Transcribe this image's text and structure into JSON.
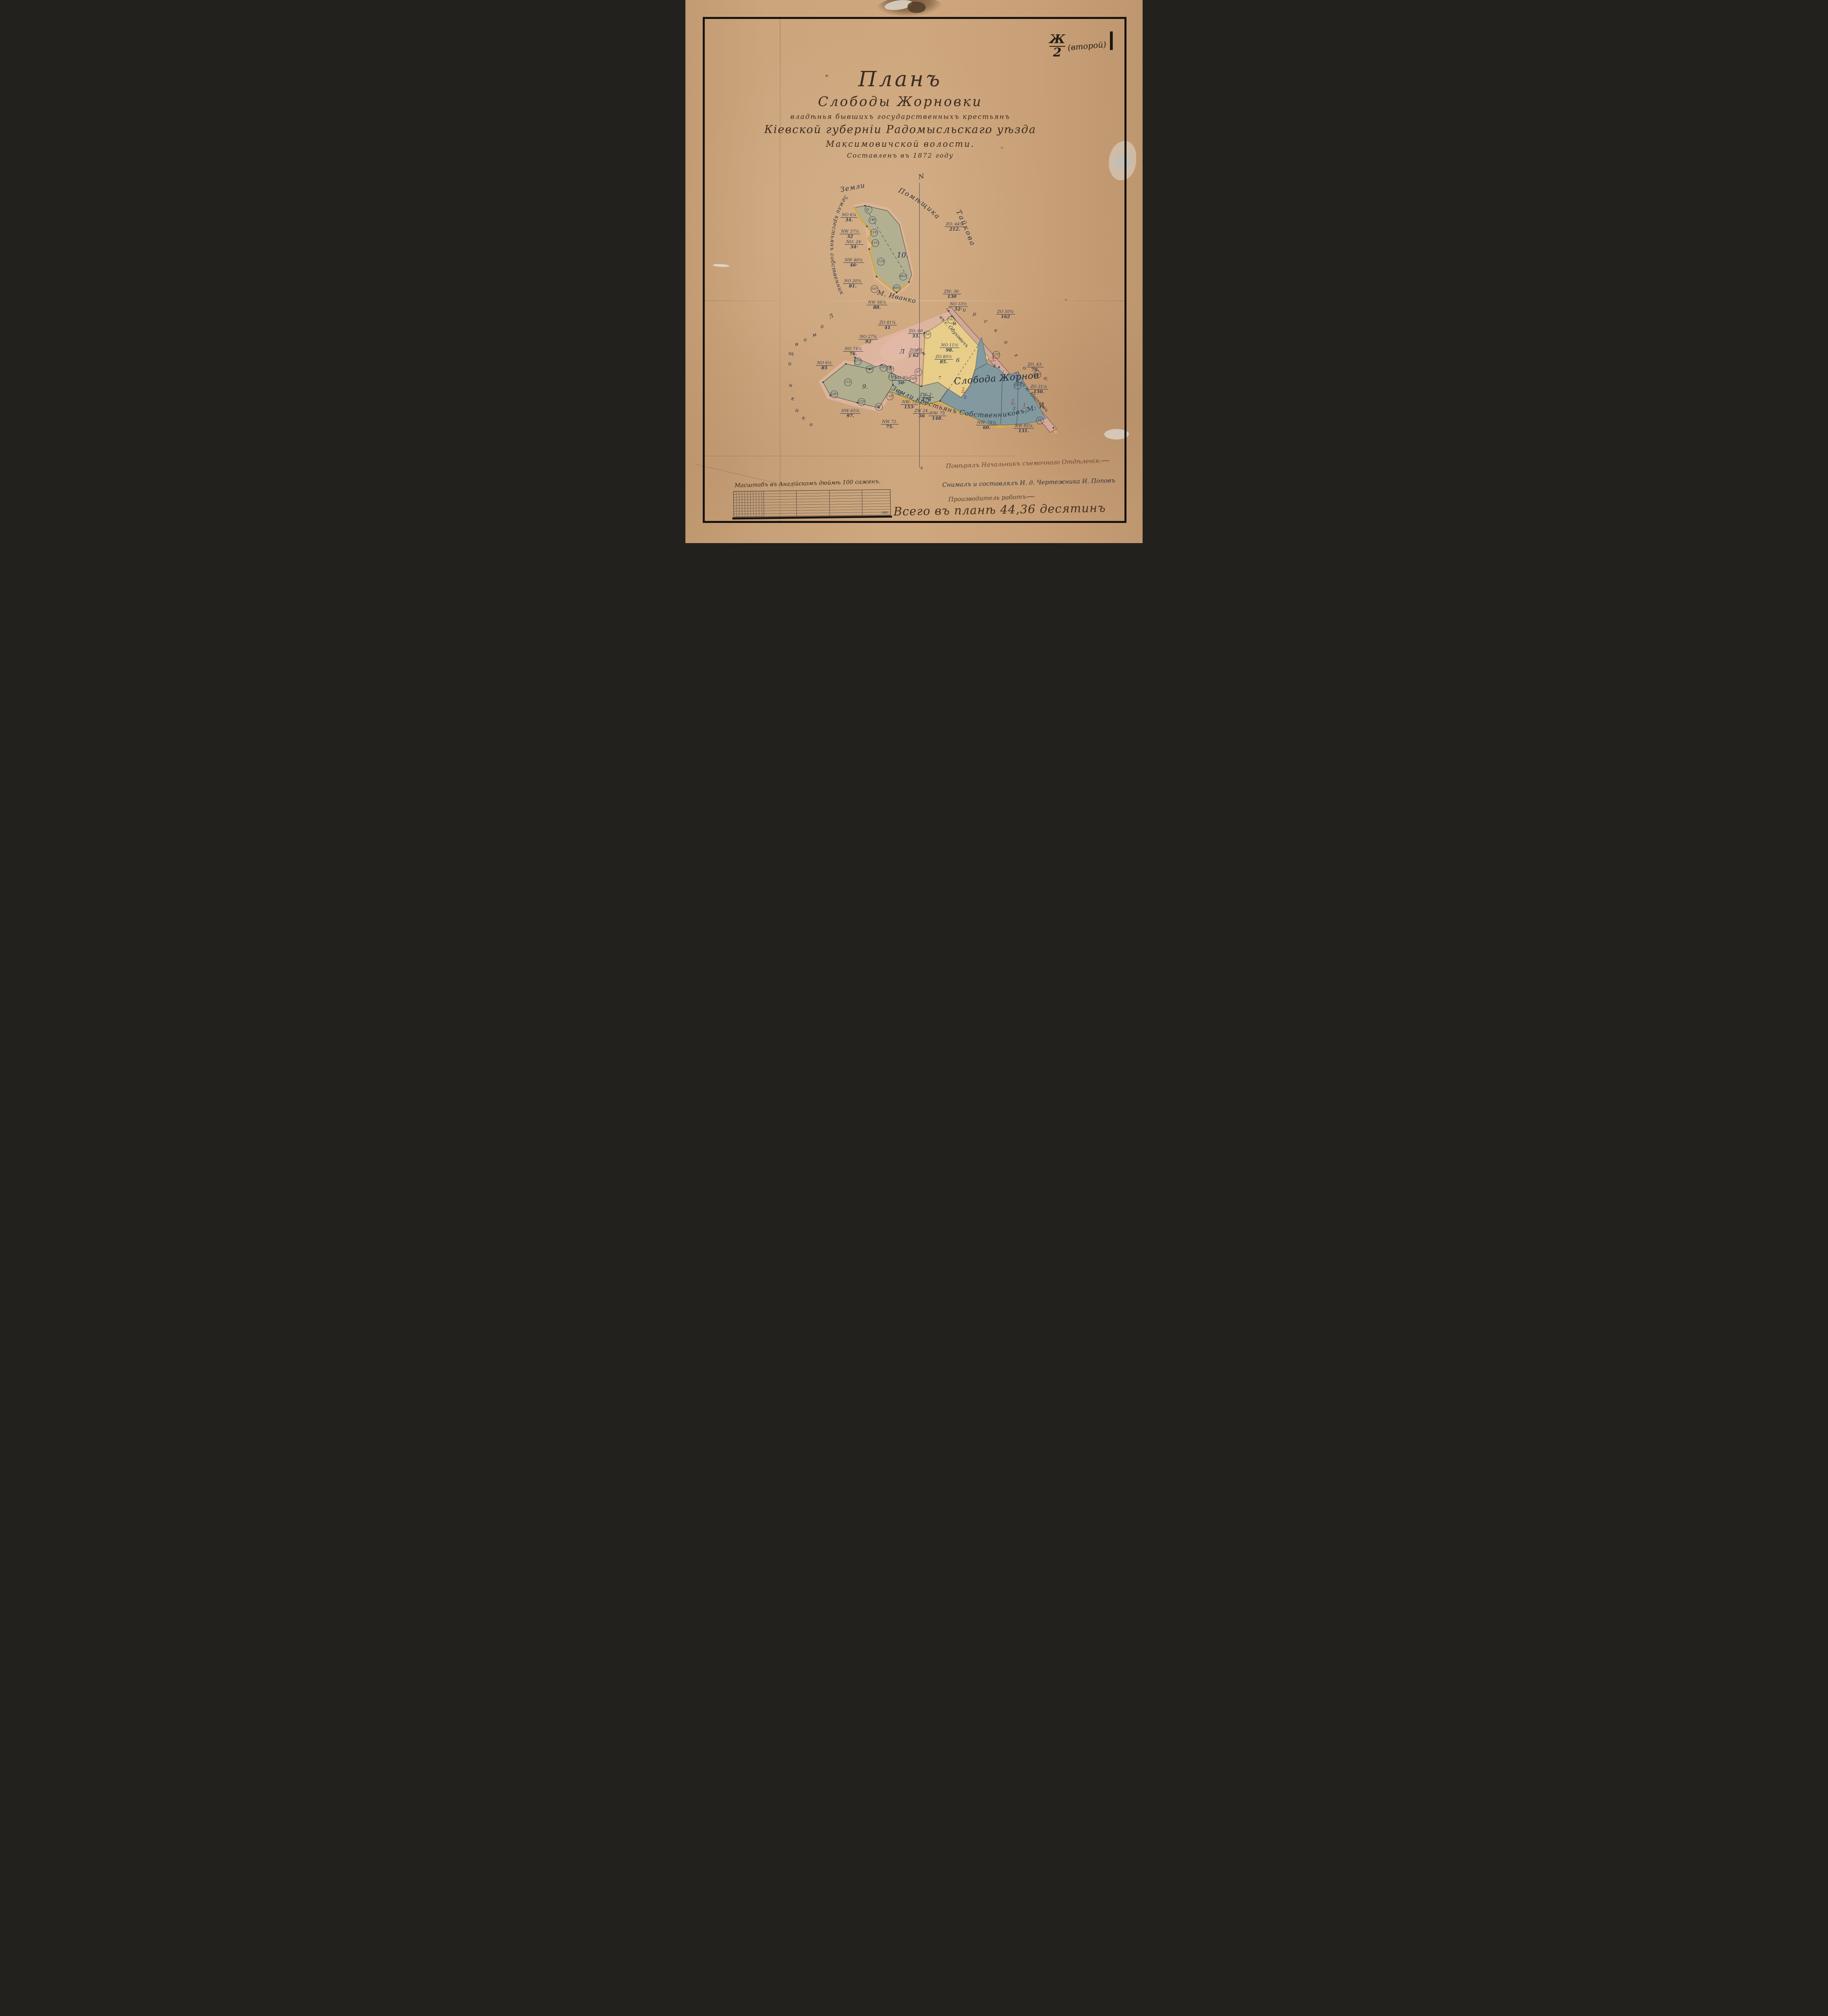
{
  "stamp": {
    "numerator": "Ж",
    "denominator": "2",
    "suffix": "(второй)"
  },
  "title": {
    "l1": "Планъ",
    "l2": "Слободы Жорновки",
    "l3": "владѣнья бывшихъ государственныхъ крестьянъ",
    "l4": "Кіевской губерніи Радомысльскаго уѣзда",
    "l5": "Максимовичской волости.",
    "l6": "Составленъ въ 1872 году"
  },
  "compass": {
    "north": "N",
    "south": "s"
  },
  "labels": {
    "top1": "Земли",
    "top2": "Помѣщика",
    "top3": "Тайкова",
    "left_arc": "Земли крестьянъ собственниковъ",
    "left_owner": "М. Иванкова",
    "bottom_boundary": "Земли крестьянъ Собственниковъ М: Иванкова.",
    "settlement": "Слобода Жорновка.",
    "road_upper": "въ с. Обуховичъ",
    "road_lower": "въ м. Иванковъ"
  },
  "colors": {
    "paper": "#cda67e",
    "ink": "#313a4e",
    "red": "#9c2c40",
    "green_parcel": "#b4b193",
    "yellow_parcel": "#e9cf8a",
    "blue_parcel": "#7f9aa3",
    "pink_edge": "#e7bcae",
    "road": "#d2a99b",
    "gold_edge": "#dcae4a"
  },
  "parcel_numbers": [
    {
      "n": "10.",
      "x": 47.5,
      "y": 47.0,
      "s": 18
    },
    {
      "n": "9.",
      "x": 39.3,
      "y": 71.2,
      "s": 15
    },
    {
      "n": "8",
      "x": 46.8,
      "y": 72.4,
      "s": 15
    },
    {
      "n": "6",
      "x": 59.6,
      "y": 66.4,
      "s": 14
    },
    {
      "n": "7",
      "x": 55.6,
      "y": 69.6,
      "s": 10
    },
    {
      "n": "4",
      "x": 67.6,
      "y": 67.4,
      "s": 11
    },
    {
      "n": "5",
      "x": 61.2,
      "y": 73.2,
      "s": 11
    },
    {
      "n": "3",
      "x": 72.6,
      "y": 70.4,
      "s": 11
    },
    {
      "n": "2",
      "x": 71.9,
      "y": 75.2,
      "s": 11
    },
    {
      "n": "1",
      "x": 74.5,
      "y": 75.9,
      "s": 10
    }
  ],
  "red_numbers": [
    {
      "n": "4",
      "x": 67.3,
      "y": 65.9
    },
    {
      "n": "2",
      "x": 60.8,
      "y": 71.7
    },
    {
      "n": "3",
      "x": 72.2,
      "y": 69.0
    },
    {
      "n": "2",
      "x": 71.6,
      "y": 73.9
    },
    {
      "n": "1",
      "x": 74.2,
      "y": 74.6
    }
  ],
  "bearings": [
    {
      "dir": "NO",
      "deg": "6¼",
      "dist": "34.",
      "x": 35.8,
      "y": 40.1
    },
    {
      "dir": "NW",
      "deg": "37¼",
      "dist": "32",
      "x": 36.0,
      "y": 43.1
    },
    {
      "dir": "NO:",
      "deg": "24·",
      "dist": "34·",
      "x": 36.9,
      "y": 45.1
    },
    {
      "dir": "NW",
      "deg": "40¼",
      "dist": "46·",
      "x": 36.8,
      "y": 48.4
    },
    {
      "dir": "NO",
      "deg": "20¼",
      "dist": "81.",
      "x": 36.6,
      "y": 52.3
    },
    {
      "dir": "NW",
      "deg": "56⅞",
      "dist": "88.",
      "x": 41.9,
      "y": 56.2
    },
    {
      "dir": "ZO:",
      "deg": "44¼",
      "dist": "212.",
      "x": 58.9,
      "y": 41.8
    },
    {
      "dir": "ZW:",
      "deg": "36·",
      "dist": "130",
      "x": 58.3,
      "y": 54.2
    },
    {
      "dir": "ZO",
      "deg": "81¾",
      "dist": "41",
      "x": 44.2,
      "y": 59.9
    },
    {
      "dir": "ZO:",
      "deg": "60",
      "dist": "33.",
      "x": 50.4,
      "y": 61.5
    },
    {
      "dir": "NO",
      "deg": "27¾",
      "dist": "92",
      "x": 40.0,
      "y": 62.5
    },
    {
      "dir": "NO",
      "deg": "74½",
      "dist": "76.",
      "x": 36.7,
      "y": 64.7
    },
    {
      "dir": "NO",
      "deg": "6½",
      "dist": "85",
      "x": 30.4,
      "y": 67.3
    },
    {
      "dir": "NW",
      "deg": "65¼",
      "dist": "97.",
      "x": 36.1,
      "y": 76.2
    },
    {
      "dir": "NW",
      "deg": "72.",
      "dist": "75.",
      "x": 44.7,
      "y": 78.2
    },
    {
      "dir": "ZW",
      "deg": "24.",
      "dist": "56",
      "x": 51.7,
      "y": 76.2
    },
    {
      "dir": "ZW:",
      "deg": "2·",
      "dist": "176",
      "x": 52.7,
      "y": 73.2
    },
    {
      "dir": "NO",
      "deg": "33½",
      "dist": "52·",
      "x": 59.7,
      "y": 56.5
    },
    {
      "dir": "ZO",
      "deg": "50¾",
      "dist": "162",
      "x": 70.0,
      "y": 57.9
    },
    {
      "dir": "NO",
      "deg": "11½",
      "dist": "98.",
      "x": 57.8,
      "y": 64.1
    },
    {
      "dir": "ZO",
      "deg": "85½",
      "dist": "85.",
      "x": 56.5,
      "y": 66.2
    },
    {
      "dir": "ZO",
      "deg": "75",
      "dist": "62",
      "x": 50.4,
      "y": 65.0
    },
    {
      "dir": "NO",
      "deg": "9¼",
      "dist": "50·",
      "x": 47.3,
      "y": 70.1
    },
    {
      "dir": "ZO,",
      "deg": "43·",
      "dist": "70.",
      "x": 76.5,
      "y": 67.6
    },
    {
      "dir": "NW:",
      "deg": "73",
      "dist": "153·",
      "x": 49.0,
      "y": 74.5
    },
    {
      "dir": "NW:",
      "deg": "75",
      "dist": "148.",
      "x": 55.1,
      "y": 76.6
    },
    {
      "dir": "NW:",
      "deg": "74¼",
      "dist": "60.",
      "x": 65.9,
      "y": 78.3
    },
    {
      "dir": "NW",
      "deg": "85¼",
      "dist": "131.",
      "x": 74.0,
      "y": 78.9
    },
    {
      "dir": "ZO",
      "deg": "31¼",
      "dist": "150.",
      "x": 77.3,
      "y": 71.7
    }
  ],
  "angles": [
    {
      "v": "51·",
      "x": 40.0,
      "y": 38.6
    },
    {
      "v": "136",
      "x": 40.9,
      "y": 40.5
    },
    {
      "v": "118¾",
      "x": 41.3,
      "y": 42.8
    },
    {
      "v": "115¾",
      "x": 41.5,
      "y": 44.8
    },
    {
      "v": "119",
      "x": 42.8,
      "y": 48.2
    },
    {
      "v": "99½",
      "x": 47.6,
      "y": 50.9
    },
    {
      "v": "105¾",
      "x": 41.4,
      "y": 53.2
    },
    {
      "v": "89¾",
      "x": 46.2,
      "y": 53.1
    },
    {
      "v": "105·",
      "x": 43.3,
      "y": 67.7
    },
    {
      "v": "156¾",
      "x": 44.8,
      "y": 68.0
    },
    {
      "v": "118·",
      "x": 45.2,
      "y": 69.4
    },
    {
      "v": "123¾",
      "x": 40.3,
      "y": 68.0
    },
    {
      "v": "112",
      "x": 35.5,
      "y": 70.4
    },
    {
      "v": "108¾",
      "x": 32.5,
      "y": 72.6
    },
    {
      "v": "173¼",
      "x": 38.5,
      "y": 74.0
    },
    {
      "v": "96·",
      "x": 42.3,
      "y": 74.9
    },
    {
      "v": "158",
      "x": 44.7,
      "y": 73.0
    },
    {
      "v": "141",
      "x": 58.1,
      "y": 58.9
    },
    {
      "v": "158·",
      "x": 52.9,
      "y": 61.6
    },
    {
      "v": "97·",
      "x": 51.0,
      "y": 68.5
    },
    {
      "v": "97½",
      "x": 37.7,
      "y": 66.5
    },
    {
      "v": "169",
      "x": 49.8,
      "y": 69.8
    },
    {
      "v": "178·",
      "x": 52.8,
      "y": 73.4
    },
    {
      "v": "173¾",
      "x": 68.0,
      "y": 65.3
    },
    {
      "v": "165½",
      "x": 77.0,
      "y": 69.0
    },
    {
      "v": "68¾",
      "x": 72.7,
      "y": 71.0
    },
    {
      "v": "65",
      "x": 77.5,
      "y": 77.4
    }
  ],
  "scattered_letters": [
    {
      "name": "tract-letter-right",
      "cls": "lr",
      "letters": [
        {
          "ch": "м",
          "x": 58.8,
          "y": 59.6,
          "rot": -15
        },
        {
          "ch": "и",
          "x": 61.0,
          "y": 57.1,
          "rot": 0
        },
        {
          "ch": "р",
          "x": 63.2,
          "y": 57.8,
          "rot": 10
        },
        {
          "ch": "с",
          "x": 65.7,
          "y": 59.2,
          "rot": 20
        },
        {
          "ch": "к",
          "x": 67.9,
          "y": 60.9,
          "rot": 30
        },
        {
          "ch": "а",
          "x": 70.1,
          "y": 63.0,
          "rot": 35
        },
        {
          "ch": "г",
          "x": 72.3,
          "y": 65.4,
          "rot": 40
        },
        {
          "ch": "о",
          "x": 74.2,
          "y": 67.8,
          "rot": 45
        },
        {
          "ch": "а.",
          "x": 78.9,
          "y": 69.7,
          "rot": 20
        }
      ]
    },
    {
      "name": "tract-letter-left",
      "cls": "ll",
      "letters": [
        {
          "ch": "Л",
          "x": 31.9,
          "y": 58.3,
          "rot": -30
        },
        {
          "ch": "о",
          "x": 29.9,
          "y": 60.1,
          "rot": -22
        },
        {
          "ch": "м",
          "x": 28.2,
          "y": 61.7,
          "rot": -16
        },
        {
          "ch": "о",
          "x": 26.2,
          "y": 62.6,
          "rot": -10
        },
        {
          "ch": "в",
          "x": 24.3,
          "y": 63.4,
          "rot": -6
        },
        {
          "ch": "щ",
          "x": 23.1,
          "y": 65.1,
          "rot": 0
        },
        {
          "ch": "и",
          "x": 22.8,
          "y": 67.0,
          "rot": 4
        },
        {
          "ch": "н",
          "x": 23.0,
          "y": 71.0,
          "rot": 10
        },
        {
          "ch": "к",
          "x": 23.5,
          "y": 73.4,
          "rot": 16
        },
        {
          "ch": "и",
          "x": 24.4,
          "y": 75.6,
          "rot": 22
        },
        {
          "ch": "к",
          "x": 25.8,
          "y": 77.0,
          "rot": 26
        },
        {
          "ch": "а",
          "x": 27.5,
          "y": 78.2,
          "rot": 30
        }
      ]
    },
    {
      "name": "meadow-letter",
      "cls": "lm",
      "letters": [
        {
          "ch": "Л",
          "x": 47.4,
          "y": 64.7,
          "rot": 0,
          "s": 15
        },
        {
          "ch": "у",
          "x": 49.1,
          "y": 65.4,
          "rot": 0
        },
        {
          "ch": "г",
          "x": 50.6,
          "y": 64.5,
          "rot": 0
        },
        {
          "ch": "ъ",
          "x": 52.1,
          "y": 65.1,
          "rot": 0
        }
      ]
    }
  ],
  "scale_bar": {
    "title": "Масштабъ въ Англійскомъ дюймѣ 100 саженъ.",
    "ticks": [
      "90",
      "70",
      "50",
      "30",
      "10"
    ],
    "end": "500."
  },
  "signatures": {
    "checked": "Повѣрялъ Начальникъ съемочнаго Отдѣленія:",
    "surveyed": "Снималъ и составлялъ И. д. Чертежника И. Поповъ",
    "works": "Производитель работъ",
    "total": "Всего въ планѣ 44,36 десятинъ"
  }
}
